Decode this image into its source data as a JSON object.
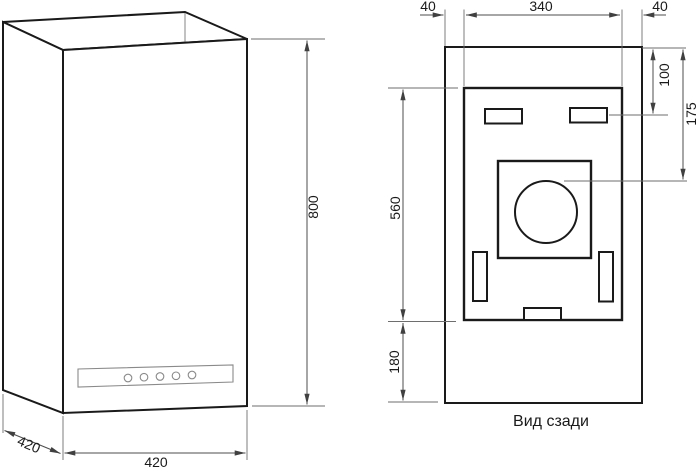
{
  "drawing": {
    "caption": "Вид сзади",
    "isometric_view": {
      "height_mm": "800",
      "width_mm": "420",
      "depth_mm": "420"
    },
    "rear_view": {
      "left_margin_mm": "40",
      "inner_width_mm": "340",
      "right_margin_mm": "40",
      "slot_offset_mm": "100",
      "fan_offset_mm": "175",
      "plate_height_mm": "560",
      "bottom_offset_mm": "180"
    },
    "colors": {
      "outline": "#1a1a1a",
      "dimension": "#4d4d4d",
      "background": "#ffffff"
    }
  }
}
